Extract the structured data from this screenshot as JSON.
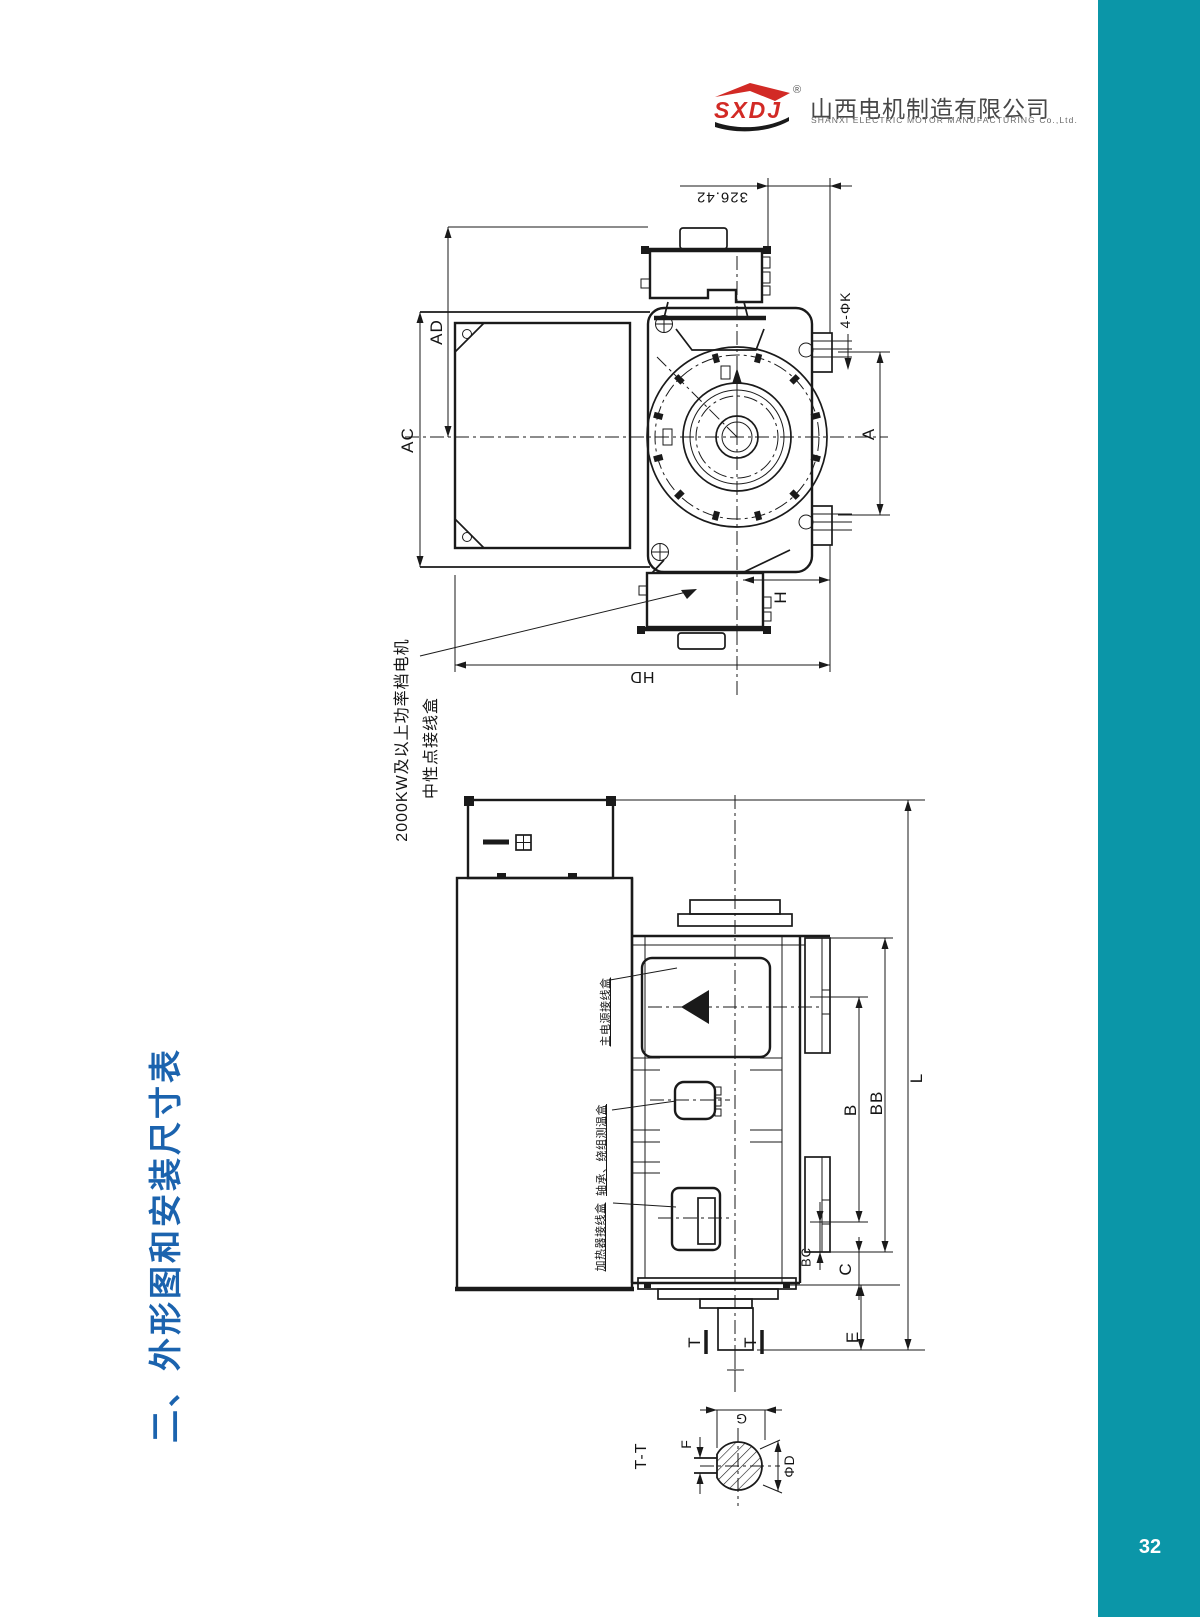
{
  "page": {
    "number": "32"
  },
  "header": {
    "logo_brand": "SXDJ",
    "registered": "®",
    "company_cn": "山西电机制造有限公司",
    "company_en": "SHANXI ELECTRIC MOTOR MANUFACTURING Co.,Ltd."
  },
  "title": {
    "text": "二、外形图和安装尺寸表"
  },
  "colors": {
    "accent_teal": "#0b96a8",
    "title_blue": "#1b63ae",
    "logo_red": "#d22a25",
    "line_black": "#1a1a1a"
  },
  "drawing_end_view": {
    "dim_value": "326.42",
    "dim_ad": "AD",
    "dim_ac": "AC",
    "dim_a": "A",
    "dim_k": "4-ΦK",
    "dim_h": "H",
    "dim_hd": "HD",
    "note_line1": "2000KW及以上功率档电机",
    "note_line2": "中性点接线盒"
  },
  "drawing_side_view": {
    "dim_b": "B",
    "dim_bb": "BB",
    "dim_l": "L",
    "dim_bc": "BC",
    "dim_c": "C",
    "dim_e": "E",
    "section_mark": "T",
    "note_main_power": "主电源接线盒",
    "note_temp": "轴承、绕组测温盒",
    "note_heater": "加热器接线盒"
  },
  "section_view": {
    "label": "T-T",
    "dim_g": "G",
    "dim_f": "F",
    "dim_d": "ΦD"
  }
}
